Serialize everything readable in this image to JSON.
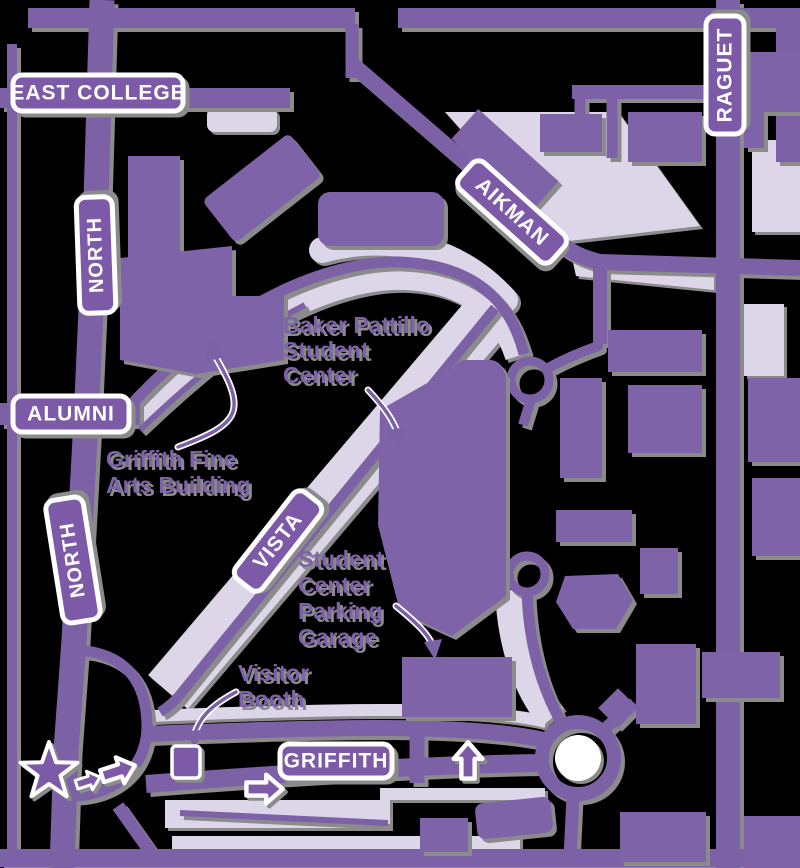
{
  "map": {
    "title": "campus-driving-directions-map",
    "colors": {
      "background": "#000000",
      "road": "#7C61A7",
      "building": "#7E63A9",
      "parking": "#DCD6E8",
      "sign_fill": "#7D5AA8",
      "sign_text": "#FFFFFF",
      "label_text": "#7D62A8",
      "shadow": "#8B8B8B",
      "white": "#FFFFFF"
    },
    "street_signs": [
      {
        "id": "east-college",
        "label": "EAST COLLEGE"
      },
      {
        "id": "north-upper",
        "label": "NORTH"
      },
      {
        "id": "alumni",
        "label": "ALUMNI"
      },
      {
        "id": "north-lower",
        "label": "NORTH"
      },
      {
        "id": "vista",
        "label": "VISTA"
      },
      {
        "id": "aikman",
        "label": "AIKMAN"
      },
      {
        "id": "raguet",
        "label": "RAGUET"
      },
      {
        "id": "griffith",
        "label": "GRIFFITH"
      }
    ],
    "building_labels": [
      {
        "id": "baker-pattillo-student-center",
        "lines": [
          "Baker Pattillo",
          "Student",
          "Center"
        ]
      },
      {
        "id": "griffith-fine-arts-building",
        "lines": [
          "Griffith Fine",
          "Arts Building"
        ]
      },
      {
        "id": "student-center-parking-garage",
        "lines": [
          "Student",
          "Center",
          "Parking",
          "Garage"
        ]
      },
      {
        "id": "visitor-booth",
        "lines": [
          "Visitor",
          "Booth"
        ]
      }
    ],
    "icons": {
      "start_marker": "star-icon",
      "route_arrows": "direction-arrow-icon",
      "roundabout": "traffic-circle"
    }
  }
}
